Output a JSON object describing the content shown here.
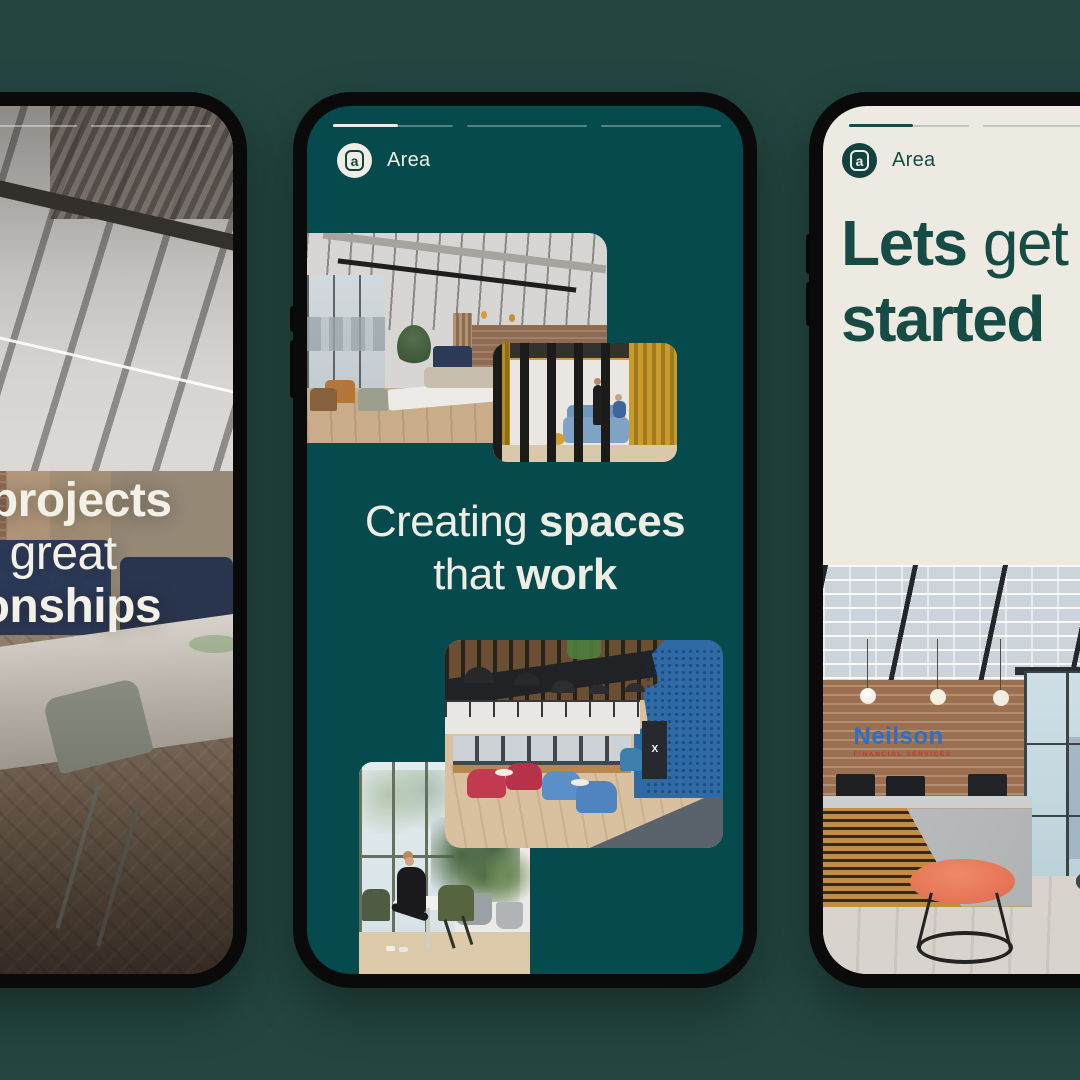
{
  "canvas": {
    "bg_color": "#244640"
  },
  "brand": {
    "name": "Area",
    "logomark_letter": "a"
  },
  "left_phone": {
    "progress": {
      "segments": 3,
      "active_segment": 1,
      "fill_pct": 0
    },
    "headline": {
      "l1_light": "Great ",
      "l1_bold": "projects",
      "l2_light": "with great",
      "l3_bold": "relationships"
    },
    "photo_description": "Industrial office cafe: exposed-services ceiling, glass pendant lights, brick wall, navy booth seating, long table with fruit bowls and sage chairs on herringbone wood floor"
  },
  "middle_phone": {
    "screen_color": "#054B4D",
    "logo_label": "Area",
    "progress": {
      "segments": 3,
      "active_segment": 1,
      "fill_pct": 54
    },
    "headline": {
      "l1_light": "Creating ",
      "l1_bold": "spaces",
      "l2_light": "that ",
      "l2_bold": "work"
    },
    "photos": {
      "top_left_description": "Open-plan office with exposed ceiling, city-view windows, brick wall, navy booths and white meeting table",
      "top_right_description": "Meeting nook behind dark timber slats with mustard curtains, two people talking beside a blue sofa",
      "bottom_right_description": "Mezzanine lounge with dome pendant lamps, blue acoustic wall, banquette bench, red and blue tub chairs",
      "bottom_right_kiosk_label": "X",
      "bottom_left_description": "Woman checking her phone at a round cafe table beside a window, surrounded by potted plants"
    }
  },
  "right_phone": {
    "screen_color": "#EDEBE1",
    "logo_label": "Area",
    "progress": {
      "segments": 3,
      "active_segment": 1,
      "fill_pct": 53
    },
    "headline": {
      "l1_bold": "Lets",
      "l1_light": " get",
      "l2_bold": "started"
    },
    "photo": {
      "sign_line1": "Neilson",
      "sign_line2": "FINANCIAL SERVICES",
      "description": "Reception with brick feature wall and Neilson Financial Services signage, timber-slat and concrete desk, glass wall, coral stool and dark side table"
    }
  },
  "accent_colors": {
    "story_teal": "#054B4D",
    "cream": "#EDEBE1",
    "headline_teal": "#174B45",
    "sign_blue": "#2F6FC2",
    "sign_red": "#C23B30",
    "stool_coral": "#E87D5F",
    "booth_navy": "#2C3A57",
    "curtain_mustard": "#C79C2D"
  }
}
